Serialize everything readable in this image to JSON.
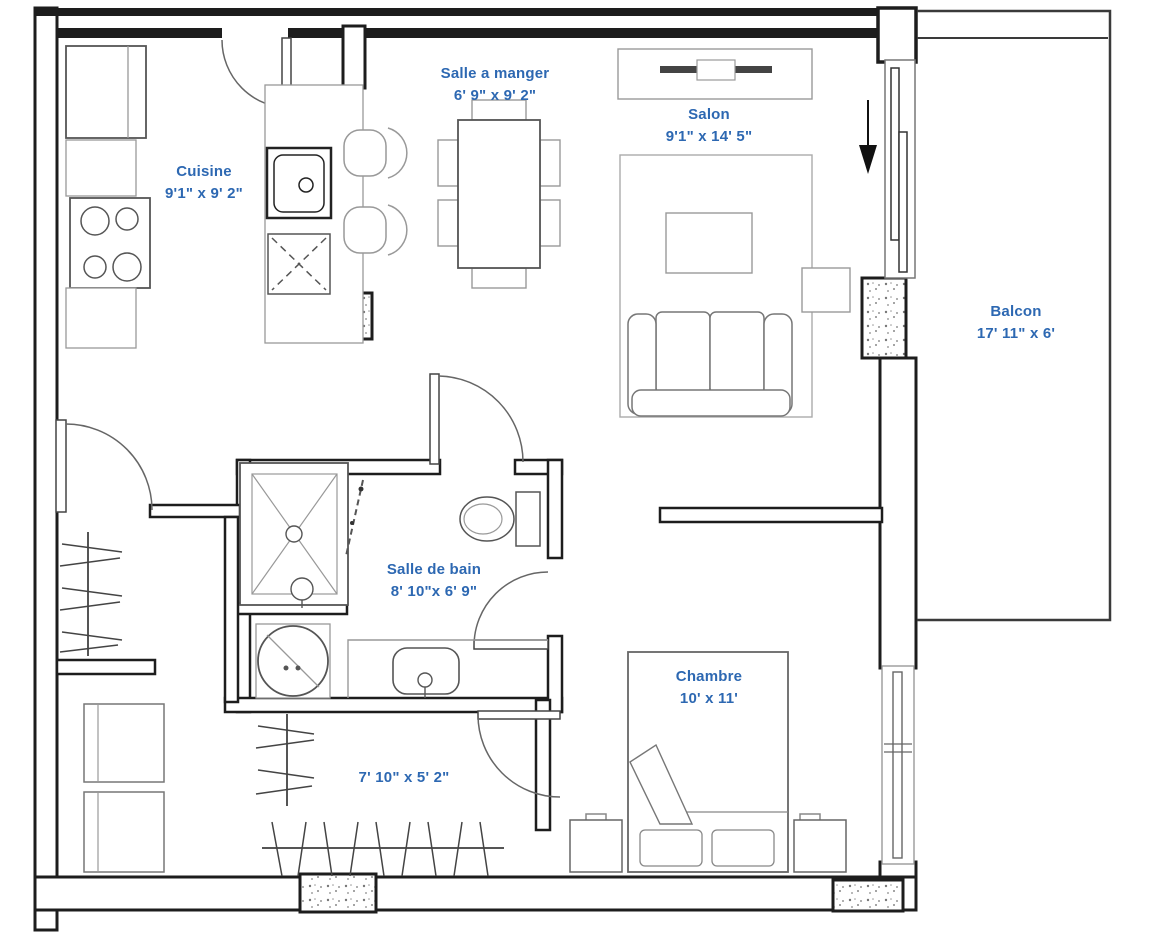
{
  "plan": {
    "type": "apartment-floor-plan",
    "language": "fr",
    "rooms": [
      {
        "id": "salle-a-manger",
        "label": "Salle a manger",
        "dims": "6' 9\" x 9' 2\""
      },
      {
        "id": "salon",
        "label": "Salon",
        "dims": "9'1\" x 14' 5\""
      },
      {
        "id": "cuisine",
        "label": "Cuisine",
        "dims": "9'1\" x 9' 2\""
      },
      {
        "id": "balcon",
        "label": "Balcon",
        "dims": "17' 11\" x 6'"
      },
      {
        "id": "salle-de-bain",
        "label": "Salle de bain",
        "dims": "8' 10\"x 6' 9\""
      },
      {
        "id": "chambre",
        "label": "Chambre",
        "dims": "10' x 11'"
      },
      {
        "id": "garde-robe",
        "label": "",
        "dims": "7' 10\" x 5' 2\""
      }
    ],
    "colors": {
      "label_blue": "#2d68b2",
      "wall_black": "#1d1d1d",
      "furniture_gray": "#8a8a8a"
    },
    "icons": [
      "entry-arrow-icon",
      "door-swing-icon",
      "sliding-door-icon",
      "hanging-rod-icon",
      "structural-column-icon"
    ],
    "fixtures": [
      "fridge",
      "stove",
      "lower-cabinets",
      "kitchen-peninsula",
      "kitchen-sink",
      "dishwasher",
      "bar-stools",
      "dining-table",
      "dining-chairs",
      "tv-console",
      "tv",
      "area-rug",
      "coffee-table",
      "side-table",
      "sofa",
      "shower",
      "shower-door",
      "toilet",
      "vanity-sink",
      "laundry-tub",
      "washer",
      "dryer",
      "closet-rods",
      "bed",
      "pillows",
      "nightstands",
      "bedroom-window",
      "sliding-patio-door"
    ]
  }
}
